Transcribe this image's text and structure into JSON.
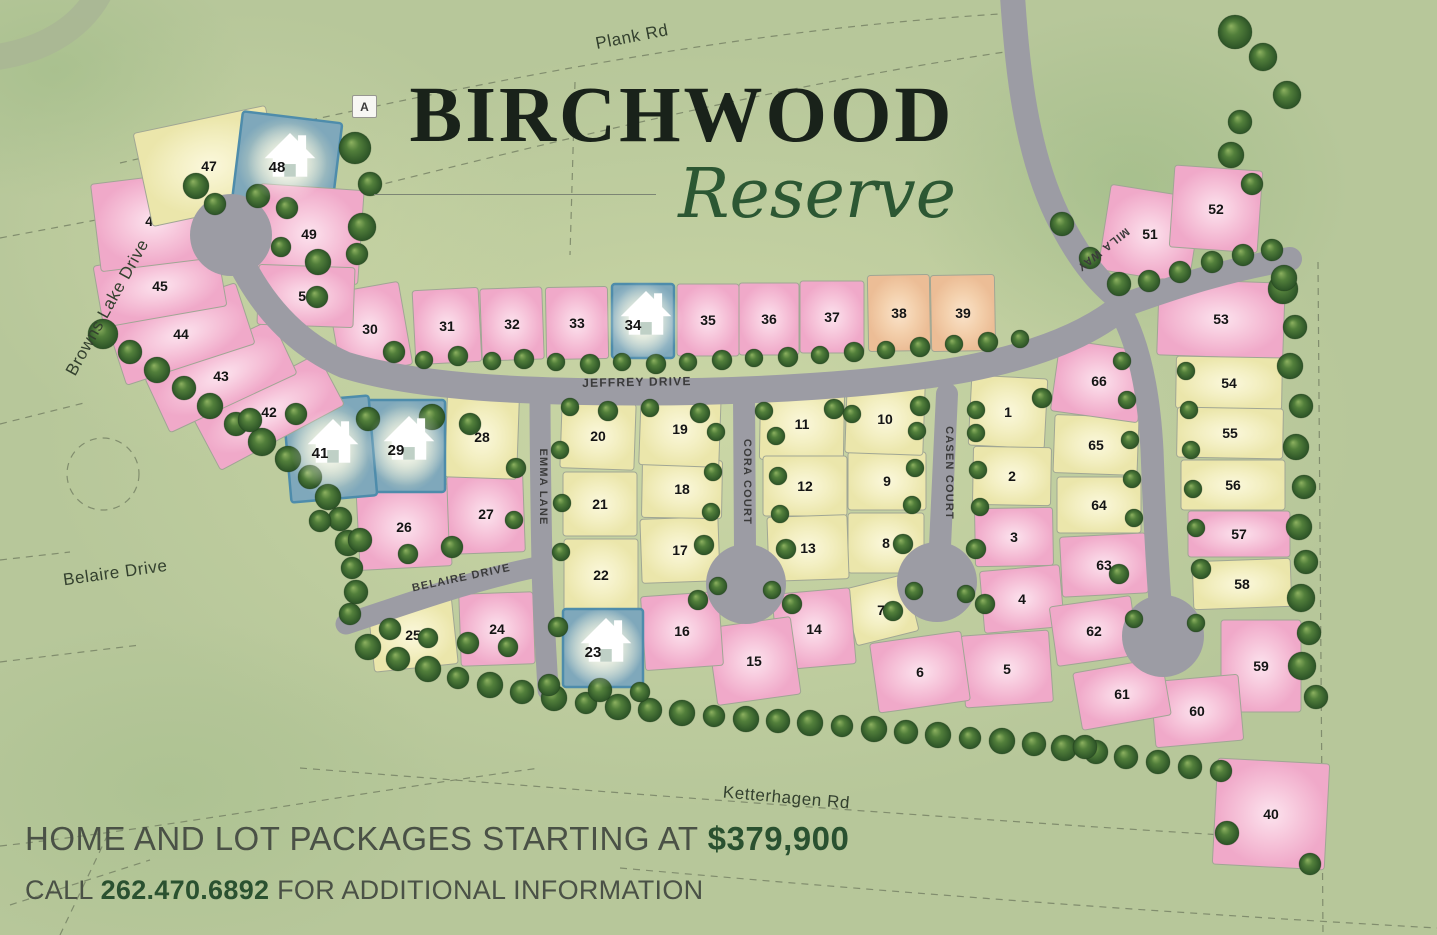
{
  "title": {
    "primary": "BIRCHWOOD",
    "secondary": "Reserve",
    "marker_label": "A"
  },
  "footer": {
    "line1_text": "HOME AND LOT PACKAGES STARTING AT",
    "line1_price": "$379,900",
    "line2_pre": "CALL",
    "line2_phone": "262.470.6892",
    "line2_post": "FOR ADDITIONAL INFORMATION"
  },
  "colors": {
    "background_green": "#b7c79a",
    "interior_green": "#ccd8a6",
    "road_gray": "#9c9ca4",
    "lot_pink": "#f2aecd",
    "lot_yellow": "#eeeab3",
    "lot_salmon": "#efc19e",
    "lot_sold_blue": "#7fa8bb",
    "sold_border_blue": "#4e8cab",
    "tree_green": "#2d5727",
    "title_ink": "#19221a",
    "script_green": "#2c5733",
    "accent_green": "#2a5130",
    "footer_text": "#4a5146"
  },
  "legend_note": "sold lots shown in blue with house icon",
  "roads": [
    {
      "id": "plank-rd",
      "label": "Plank Rd",
      "x": 633,
      "y": 42,
      "rot": -11,
      "size": 17,
      "style": "outside"
    },
    {
      "id": "browns-lake-drive",
      "label": "Browns Lake Drive",
      "x": 112,
      "y": 310,
      "rot": -61,
      "size": 17,
      "style": "outside"
    },
    {
      "id": "belaire-drive-west",
      "label": "Belaire Drive",
      "x": 116,
      "y": 578,
      "rot": -8,
      "size": 17,
      "style": "outside"
    },
    {
      "id": "ketterhagen-rd",
      "label": "Ketterhagen Rd",
      "x": 786,
      "y": 803,
      "rot": 5,
      "size": 17,
      "style": "outside"
    },
    {
      "id": "jeffrey-drive",
      "label": "JEFFREY DRIVE",
      "x": 637,
      "y": 386,
      "rot": -1,
      "size": 12,
      "style": "street"
    },
    {
      "id": "emma-lane",
      "label": "EMMA LANE",
      "x": 540,
      "y": 487,
      "rot": 90,
      "size": 11,
      "style": "street"
    },
    {
      "id": "cora-court",
      "label": "CORA COURT",
      "x": 744,
      "y": 482,
      "rot": 90,
      "size": 11,
      "style": "street"
    },
    {
      "id": "casen-court",
      "label": "CASEN COURT",
      "x": 946,
      "y": 473,
      "rot": 90,
      "size": 11,
      "style": "street"
    },
    {
      "id": "mila-way",
      "label": "MILA WAY",
      "x": 1101,
      "y": 247,
      "rot": 142,
      "size": 11,
      "style": "street"
    },
    {
      "id": "belaire-drive-inner",
      "label": "BELAIRE DRIVE",
      "x": 462,
      "y": 581,
      "rot": -12,
      "size": 11,
      "style": "street"
    }
  ],
  "lots": [
    [
      1,
      1008,
      412,
      76,
      70,
      3,
      "y"
    ],
    [
      2,
      1012,
      476,
      78,
      58,
      1,
      "y"
    ],
    [
      3,
      1014,
      537,
      78,
      58,
      -1,
      "p"
    ],
    [
      4,
      1022,
      599,
      80,
      62,
      -5,
      "p"
    ],
    [
      5,
      1007,
      669,
      88,
      72,
      -4,
      "p"
    ],
    [
      6,
      920,
      672,
      92,
      70,
      -8,
      "p"
    ],
    [
      7,
      881,
      610,
      64,
      58,
      -14,
      "y"
    ],
    [
      8,
      886,
      543,
      76,
      60,
      0,
      "y"
    ],
    [
      9,
      887,
      481,
      78,
      58,
      0,
      "y"
    ],
    [
      10,
      885,
      419,
      78,
      70,
      2,
      "y"
    ],
    [
      11,
      802,
      424,
      84,
      72,
      1,
      "y"
    ],
    [
      12,
      805,
      486,
      84,
      60,
      0,
      "y"
    ],
    [
      13,
      808,
      548,
      80,
      64,
      -2,
      "y"
    ],
    [
      14,
      814,
      629,
      78,
      76,
      -5,
      "p"
    ],
    [
      15,
      754,
      661,
      84,
      78,
      -8,
      "p"
    ],
    [
      16,
      682,
      631,
      78,
      74,
      -4,
      "p"
    ],
    [
      17,
      680,
      550,
      78,
      64,
      -2,
      "y"
    ],
    [
      18,
      682,
      489,
      80,
      58,
      1,
      "y"
    ],
    [
      19,
      680,
      429,
      80,
      74,
      2,
      "y"
    ],
    [
      20,
      598,
      436,
      74,
      66,
      2,
      "y"
    ],
    [
      21,
      600,
      504,
      74,
      64,
      0,
      "y"
    ],
    [
      22,
      601,
      575,
      74,
      72,
      0,
      "y"
    ],
    [
      23,
      603,
      648,
      80,
      78,
      0,
      "b"
    ],
    [
      24,
      497,
      629,
      74,
      72,
      -2,
      "p"
    ],
    [
      25,
      413,
      635,
      84,
      66,
      -6,
      "y"
    ],
    [
      26,
      404,
      527,
      92,
      82,
      -3,
      "p"
    ],
    [
      27,
      486,
      514,
      76,
      78,
      -2,
      "p"
    ],
    [
      28,
      482,
      437,
      72,
      82,
      2,
      "y"
    ],
    [
      29,
      406,
      446,
      78,
      92,
      0,
      "b"
    ],
    [
      30,
      370,
      329,
      72,
      84,
      -10,
      "p"
    ],
    [
      31,
      447,
      326,
      66,
      74,
      -3,
      "p"
    ],
    [
      32,
      512,
      324,
      62,
      72,
      -2,
      "p"
    ],
    [
      33,
      577,
      323,
      62,
      72,
      -1,
      "p"
    ],
    [
      34,
      643,
      321,
      62,
      74,
      0,
      "b"
    ],
    [
      35,
      708,
      320,
      62,
      72,
      0,
      "p"
    ],
    [
      36,
      769,
      319,
      60,
      72,
      0,
      "p"
    ],
    [
      37,
      832,
      317,
      64,
      72,
      0,
      "p"
    ],
    [
      38,
      899,
      313,
      62,
      76,
      -1,
      "s"
    ],
    [
      39,
      963,
      313,
      64,
      76,
      -1,
      "s"
    ],
    [
      40,
      1271,
      814,
      112,
      106,
      3,
      "p"
    ],
    [
      41,
      330,
      449,
      86,
      100,
      -5,
      "b"
    ],
    [
      42,
      269,
      412,
      140,
      58,
      -28,
      "p"
    ],
    [
      43,
      221,
      376,
      140,
      60,
      -25,
      "p"
    ],
    [
      44,
      181,
      334,
      135,
      64,
      -18,
      "p"
    ],
    [
      45,
      160,
      286,
      125,
      62,
      -10,
      "p"
    ],
    [
      46,
      153,
      221,
      115,
      88,
      -7,
      "p"
    ],
    [
      47,
      209,
      166,
      135,
      95,
      -12,
      "y"
    ],
    [
      48,
      287,
      163,
      100,
      92,
      7,
      "b"
    ],
    [
      49,
      309,
      234,
      104,
      94,
      4,
      "p"
    ],
    [
      50,
      306,
      296,
      96,
      60,
      2,
      "p"
    ],
    [
      51,
      1150,
      234,
      92,
      86,
      9,
      "p"
    ],
    [
      52,
      1216,
      209,
      88,
      82,
      4,
      "p"
    ],
    [
      53,
      1221,
      319,
      126,
      76,
      2,
      "p"
    ],
    [
      54,
      1229,
      383,
      106,
      52,
      1,
      "y"
    ],
    [
      55,
      1230,
      433,
      106,
      50,
      1,
      "y"
    ],
    [
      56,
      1233,
      485,
      104,
      50,
      0,
      "y"
    ],
    [
      57,
      1239,
      534,
      102,
      46,
      0,
      "p"
    ],
    [
      58,
      1242,
      584,
      98,
      48,
      -2,
      "y"
    ],
    [
      59,
      1261,
      666,
      80,
      92,
      0,
      "p"
    ],
    [
      60,
      1197,
      711,
      88,
      66,
      -5,
      "p"
    ],
    [
      61,
      1122,
      694,
      90,
      58,
      -10,
      "p"
    ],
    [
      62,
      1094,
      631,
      82,
      60,
      -8,
      "p"
    ],
    [
      63,
      1104,
      565,
      86,
      60,
      -3,
      "p"
    ],
    [
      64,
      1099,
      505,
      84,
      56,
      0,
      "y"
    ],
    [
      65,
      1096,
      445,
      84,
      58,
      2,
      "y"
    ],
    [
      66,
      1099,
      381,
      88,
      72,
      8,
      "p"
    ]
  ],
  "trees": [
    [
      103,
      334,
      15
    ],
    [
      130,
      352,
      12
    ],
    [
      157,
      370,
      13
    ],
    [
      184,
      388,
      12
    ],
    [
      210,
      406,
      13
    ],
    [
      236,
      424,
      12
    ],
    [
      262,
      442,
      14
    ],
    [
      288,
      459,
      13
    ],
    [
      310,
      477,
      12
    ],
    [
      328,
      497,
      13
    ],
    [
      340,
      519,
      12
    ],
    [
      348,
      543,
      13
    ],
    [
      352,
      568,
      11
    ],
    [
      356,
      592,
      12
    ],
    [
      350,
      614,
      11
    ],
    [
      368,
      647,
      13
    ],
    [
      398,
      659,
      12
    ],
    [
      428,
      669,
      13
    ],
    [
      458,
      678,
      11
    ],
    [
      490,
      685,
      13
    ],
    [
      522,
      692,
      12
    ],
    [
      554,
      698,
      13
    ],
    [
      586,
      703,
      11
    ],
    [
      618,
      707,
      13
    ],
    [
      650,
      710,
      12
    ],
    [
      682,
      713,
      13
    ],
    [
      714,
      716,
      11
    ],
    [
      746,
      719,
      13
    ],
    [
      778,
      721,
      12
    ],
    [
      810,
      723,
      13
    ],
    [
      842,
      726,
      11
    ],
    [
      874,
      729,
      13
    ],
    [
      906,
      732,
      12
    ],
    [
      938,
      735,
      13
    ],
    [
      970,
      738,
      11
    ],
    [
      1002,
      741,
      13
    ],
    [
      1034,
      744,
      12
    ],
    [
      1064,
      748,
      13
    ],
    [
      1096,
      752,
      12
    ],
    [
      1126,
      757,
      12
    ],
    [
      1158,
      762,
      12
    ],
    [
      1190,
      767,
      12
    ],
    [
      1221,
      771,
      11
    ],
    [
      1283,
      289,
      15
    ],
    [
      1295,
      327,
      12
    ],
    [
      1290,
      366,
      13
    ],
    [
      1301,
      406,
      12
    ],
    [
      1296,
      447,
      13
    ],
    [
      1304,
      487,
      12
    ],
    [
      1299,
      527,
      13
    ],
    [
      1306,
      562,
      12
    ],
    [
      1301,
      598,
      14
    ],
    [
      1309,
      633,
      12
    ],
    [
      1302,
      666,
      14
    ],
    [
      1316,
      697,
      12
    ],
    [
      1085,
      747,
      12
    ],
    [
      1227,
      833,
      12
    ],
    [
      1310,
      864,
      11
    ],
    [
      1235,
      32,
      17
    ],
    [
      1263,
      57,
      14
    ],
    [
      1287,
      95,
      14
    ],
    [
      1240,
      122,
      12
    ],
    [
      1231,
      155,
      13
    ],
    [
      1252,
      184,
      11
    ],
    [
      1284,
      278,
      13
    ],
    [
      1062,
      224,
      12
    ],
    [
      1090,
      258,
      11
    ],
    [
      1119,
      284,
      12
    ],
    [
      1149,
      281,
      11
    ],
    [
      1180,
      272,
      11
    ],
    [
      1212,
      262,
      11
    ],
    [
      1243,
      255,
      11
    ],
    [
      1272,
      250,
      11
    ],
    [
      196,
      186,
      13
    ],
    [
      215,
      204,
      11
    ],
    [
      258,
      196,
      12
    ],
    [
      287,
      208,
      11
    ],
    [
      318,
      262,
      13
    ],
    [
      317,
      297,
      11
    ],
    [
      281,
      247,
      10
    ],
    [
      355,
      148,
      16
    ],
    [
      370,
      184,
      12
    ],
    [
      362,
      227,
      14
    ],
    [
      357,
      254,
      11
    ],
    [
      394,
      352,
      11
    ],
    [
      424,
      360,
      9
    ],
    [
      458,
      356,
      10
    ],
    [
      492,
      361,
      9
    ],
    [
      524,
      359,
      10
    ],
    [
      556,
      362,
      9
    ],
    [
      590,
      364,
      10
    ],
    [
      622,
      362,
      9
    ],
    [
      656,
      364,
      10
    ],
    [
      688,
      362,
      9
    ],
    [
      722,
      360,
      10
    ],
    [
      754,
      358,
      9
    ],
    [
      788,
      357,
      10
    ],
    [
      820,
      355,
      9
    ],
    [
      854,
      352,
      10
    ],
    [
      886,
      350,
      9
    ],
    [
      920,
      347,
      10
    ],
    [
      954,
      344,
      9
    ],
    [
      988,
      342,
      10
    ],
    [
      1020,
      339,
      9
    ],
    [
      570,
      407,
      9
    ],
    [
      608,
      411,
      10
    ],
    [
      650,
      408,
      9
    ],
    [
      700,
      413,
      10
    ],
    [
      764,
      411,
      9
    ],
    [
      834,
      409,
      10
    ],
    [
      852,
      414,
      9
    ],
    [
      920,
      406,
      10
    ],
    [
      976,
      410,
      9
    ],
    [
      1042,
      398,
      10
    ],
    [
      516,
      468,
      10
    ],
    [
      514,
      520,
      9
    ],
    [
      560,
      450,
      9
    ],
    [
      562,
      503,
      9
    ],
    [
      561,
      552,
      9
    ],
    [
      558,
      627,
      10
    ],
    [
      549,
      685,
      11
    ],
    [
      716,
      432,
      9
    ],
    [
      713,
      472,
      9
    ],
    [
      711,
      512,
      9
    ],
    [
      776,
      436,
      9
    ],
    [
      778,
      476,
      9
    ],
    [
      780,
      514,
      9
    ],
    [
      704,
      545,
      10
    ],
    [
      786,
      549,
      10
    ],
    [
      718,
      586,
      9
    ],
    [
      772,
      590,
      9
    ],
    [
      917,
      431,
      9
    ],
    [
      915,
      468,
      9
    ],
    [
      912,
      505,
      9
    ],
    [
      976,
      433,
      9
    ],
    [
      978,
      470,
      9
    ],
    [
      980,
      507,
      9
    ],
    [
      903,
      544,
      10
    ],
    [
      976,
      549,
      10
    ],
    [
      914,
      591,
      9
    ],
    [
      966,
      594,
      9
    ],
    [
      1122,
      361,
      9
    ],
    [
      1127,
      400,
      9
    ],
    [
      1130,
      440,
      9
    ],
    [
      1132,
      479,
      9
    ],
    [
      1134,
      518,
      9
    ],
    [
      1186,
      371,
      9
    ],
    [
      1189,
      410,
      9
    ],
    [
      1191,
      450,
      9
    ],
    [
      1193,
      489,
      9
    ],
    [
      1196,
      528,
      9
    ],
    [
      1119,
      574,
      10
    ],
    [
      1201,
      569,
      10
    ],
    [
      1134,
      619,
      9
    ],
    [
      1196,
      623,
      9
    ],
    [
      250,
      420,
      12
    ],
    [
      296,
      414,
      11
    ],
    [
      368,
      419,
      12
    ],
    [
      432,
      417,
      13
    ],
    [
      470,
      424,
      11
    ],
    [
      320,
      521,
      11
    ],
    [
      360,
      540,
      12
    ],
    [
      408,
      554,
      10
    ],
    [
      452,
      547,
      11
    ],
    [
      390,
      629,
      11
    ],
    [
      428,
      638,
      10
    ],
    [
      468,
      643,
      11
    ],
    [
      508,
      647,
      10
    ],
    [
      600,
      690,
      12
    ],
    [
      640,
      692,
      10
    ],
    [
      698,
      600,
      10
    ],
    [
      792,
      604,
      10
    ],
    [
      893,
      611,
      10
    ],
    [
      985,
      604,
      10
    ]
  ]
}
